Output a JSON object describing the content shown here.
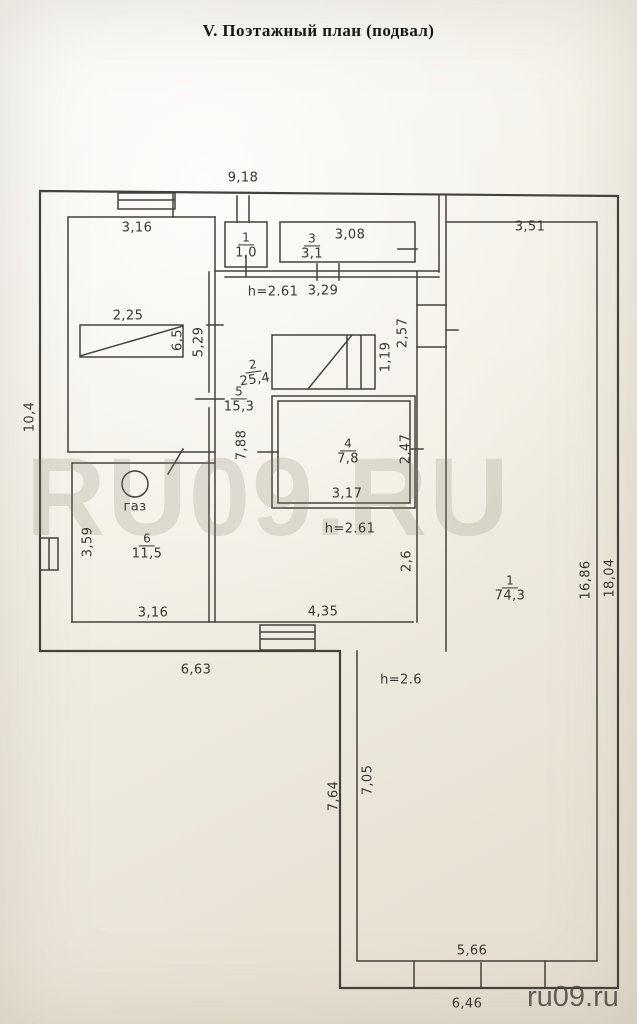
{
  "title": "V.  Поэтажный план (подвал)",
  "watermark": {
    "large": "RU09.RU",
    "small": "ru09.ru"
  },
  "colors": {
    "paper": "#f2eee5",
    "line": "#45413c",
    "watermark_large": "#c8c3b8",
    "watermark_small": "#5d5b58"
  },
  "annotations": {
    "gas": "газ"
  },
  "heights": [
    {
      "text": "h=2.61"
    },
    {
      "text": "h=2.61"
    },
    {
      "text": "h=2.6"
    }
  ],
  "rooms": [
    {
      "num": "1",
      "area": "1,0"
    },
    {
      "num": "3",
      "area": "3,1"
    },
    {
      "num": "2",
      "area": "25,4"
    },
    {
      "num": "5",
      "area": "15,3"
    },
    {
      "num": "4",
      "area": "7,8"
    },
    {
      "num": "6",
      "area": "11,5"
    },
    {
      "num": "1",
      "area": "74,3"
    }
  ],
  "dims": [
    {
      "text": "9,18"
    },
    {
      "text": "3,16"
    },
    {
      "text": "3,08"
    },
    {
      "text": "3,51"
    },
    {
      "text": "3,29"
    },
    {
      "text": "2,25"
    },
    {
      "text": "6,5"
    },
    {
      "text": "5,29"
    },
    {
      "text": "2,57"
    },
    {
      "text": "1,19"
    },
    {
      "text": "10,4"
    },
    {
      "text": "7,88"
    },
    {
      "text": "2,47"
    },
    {
      "text": "3,17"
    },
    {
      "text": "3,59"
    },
    {
      "text": "2,6"
    },
    {
      "text": "16,86"
    },
    {
      "text": "18,04"
    },
    {
      "text": "3,16"
    },
    {
      "text": "4,35"
    },
    {
      "text": "6,63"
    },
    {
      "text": "7,64"
    },
    {
      "text": "7,05"
    },
    {
      "text": "5,66"
    },
    {
      "text": "6,46"
    }
  ]
}
